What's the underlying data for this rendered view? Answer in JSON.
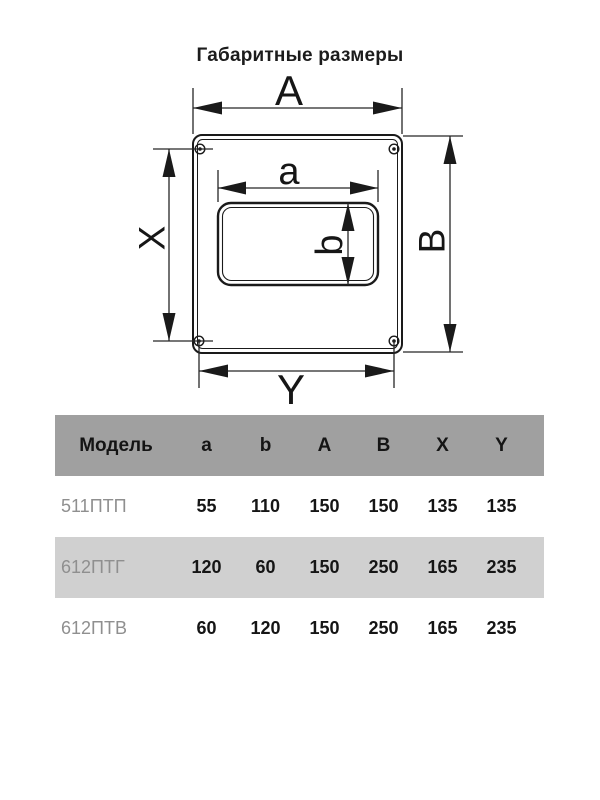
{
  "title": "Габаритные размеры",
  "diagram": {
    "labels": {
      "A": "A",
      "a": "a",
      "b": "b",
      "B": "B",
      "X": "X",
      "Y": "Y"
    },
    "line_color": "#1a1a1a"
  },
  "table": {
    "columns": [
      "Модель",
      "a",
      "b",
      "A",
      "B",
      "X",
      "Y"
    ],
    "rows": [
      {
        "model": "511ПТП",
        "values": [
          "55",
          "110",
          "150",
          "150",
          "135",
          "135"
        ]
      },
      {
        "model": "612ПТГ",
        "values": [
          "120",
          "60",
          "150",
          "250",
          "165",
          "235"
        ]
      },
      {
        "model": "612ПТВ",
        "values": [
          "60",
          "120",
          "150",
          "250",
          "165",
          "235"
        ]
      }
    ],
    "colors": {
      "header_bg": "#a0a0a0",
      "alt_row_bg": "#d0d0d0",
      "model_text": "#8f8f8f",
      "value_text": "#151515"
    }
  }
}
